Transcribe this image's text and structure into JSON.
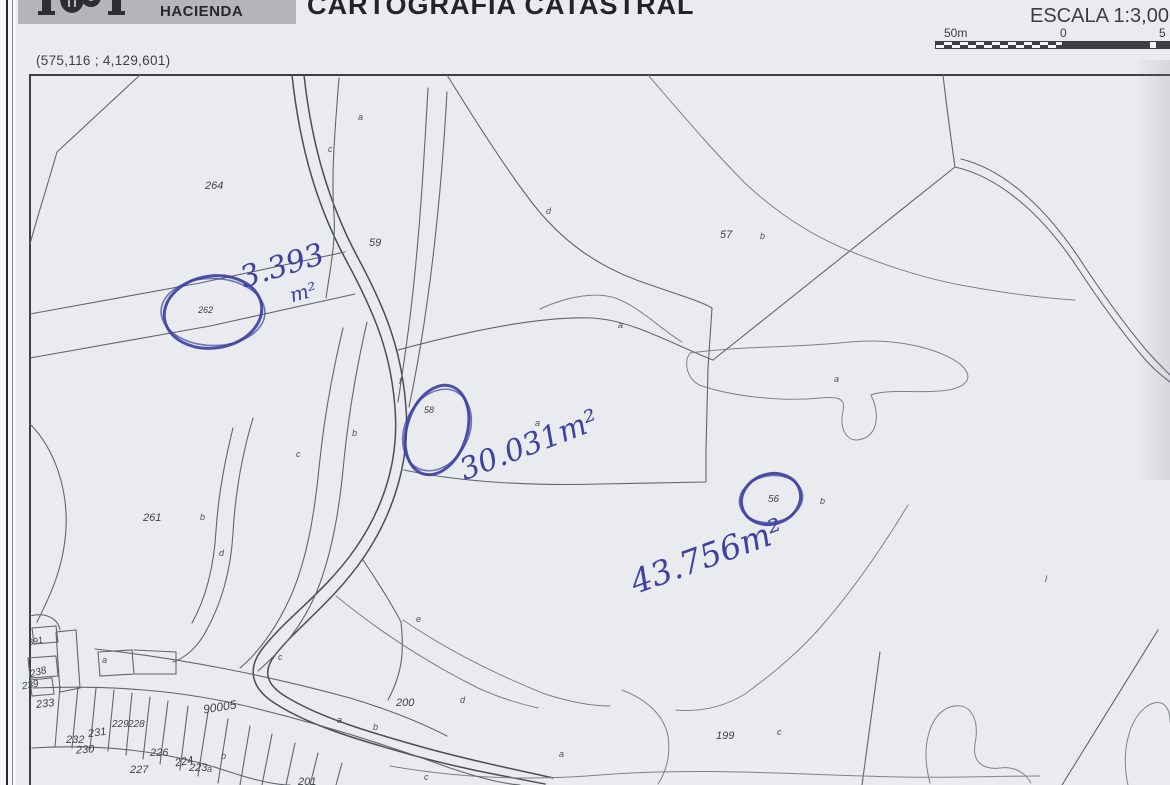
{
  "header": {
    "banner_text": "HACIENDA",
    "title": "CARTOGRAFIA CATASTRAL",
    "scale_label": "ESCALA 1:3,00",
    "scale_bar": {
      "left": "50m",
      "center": "0",
      "right": "5"
    }
  },
  "coordinates": "(575,116 ; 4,129,601)",
  "map": {
    "ink_color": "#3d41a0",
    "line_color": "#61656e",
    "parcel_labels": [
      {
        "t": "264",
        "x": 205,
        "y": 180
      },
      {
        "t": "59",
        "x": 369,
        "y": 237
      },
      {
        "t": "262",
        "x": 198,
        "y": 305,
        "s": 9
      },
      {
        "t": "57",
        "x": 720,
        "y": 229
      },
      {
        "t": "58",
        "x": 424,
        "y": 405,
        "s": 9
      },
      {
        "t": "56",
        "x": 768,
        "y": 494,
        "s": 10
      },
      {
        "t": "261",
        "x": 143,
        "y": 512
      },
      {
        "t": "200",
        "x": 396,
        "y": 697
      },
      {
        "t": "199",
        "x": 716,
        "y": 730
      },
      {
        "t": "90005",
        "x": 203,
        "y": 700,
        "s": 12,
        "rot": -9
      },
      {
        "t": "233",
        "x": 36,
        "y": 698,
        "rot": -6
      },
      {
        "t": "232",
        "x": 66,
        "y": 734
      },
      {
        "t": "231",
        "x": 88,
        "y": 727,
        "rot": -8
      },
      {
        "t": "230",
        "x": 76,
        "y": 744,
        "rot": -4
      },
      {
        "t": "229",
        "x": 112,
        "y": 719,
        "s": 10
      },
      {
        "t": "228",
        "x": 128,
        "y": 719,
        "s": 10
      },
      {
        "t": "226",
        "x": 150,
        "y": 747
      },
      {
        "t": "227",
        "x": 130,
        "y": 764
      },
      {
        "t": "224",
        "x": 175,
        "y": 756,
        "rot": -10
      },
      {
        "t": "223",
        "x": 189,
        "y": 762
      },
      {
        "t": "391",
        "x": 28,
        "y": 636,
        "s": 9,
        "rot": -12
      },
      {
        "t": "238",
        "x": 30,
        "y": 667,
        "s": 10,
        "rot": -15
      },
      {
        "t": "239",
        "x": 22,
        "y": 680,
        "s": 10,
        "rot": -10
      },
      {
        "t": "201",
        "x": 298,
        "y": 776
      }
    ],
    "letter_labels": [
      {
        "t": "a",
        "x": 358,
        "y": 112
      },
      {
        "t": "c",
        "x": 328,
        "y": 144
      },
      {
        "t": "d",
        "x": 546,
        "y": 206
      },
      {
        "t": "b",
        "x": 760,
        "y": 231
      },
      {
        "t": "a",
        "x": 618,
        "y": 320
      },
      {
        "t": "a",
        "x": 834,
        "y": 374
      },
      {
        "t": "a",
        "x": 535,
        "y": 418
      },
      {
        "t": "f",
        "x": 399,
        "y": 376
      },
      {
        "t": "b",
        "x": 352,
        "y": 428
      },
      {
        "t": "c",
        "x": 296,
        "y": 449
      },
      {
        "t": "b",
        "x": 200,
        "y": 512
      },
      {
        "t": "d",
        "x": 219,
        "y": 548
      },
      {
        "t": "e",
        "x": 416,
        "y": 614
      },
      {
        "t": "c",
        "x": 278,
        "y": 652
      },
      {
        "t": "a",
        "x": 102,
        "y": 655
      },
      {
        "t": "d",
        "x": 460,
        "y": 695
      },
      {
        "t": "a",
        "x": 337,
        "y": 715
      },
      {
        "t": "b",
        "x": 373,
        "y": 722
      },
      {
        "t": "c",
        "x": 424,
        "y": 772
      },
      {
        "t": "a",
        "x": 559,
        "y": 749
      },
      {
        "t": "c",
        "x": 777,
        "y": 727
      },
      {
        "t": "b",
        "x": 221,
        "y": 751
      },
      {
        "t": "a",
        "x": 207,
        "y": 764
      },
      {
        "t": "b",
        "x": 820,
        "y": 496
      },
      {
        "t": "l",
        "x": 1045,
        "y": 574
      }
    ],
    "annotations": [
      {
        "circle": {
          "cx": 213,
          "cy": 312,
          "rx": 49,
          "ry": 36,
          "rot": -8
        },
        "texts": [
          {
            "t": "3.393",
            "x": 236,
            "y": 262,
            "s": 30,
            "rot": -17
          },
          {
            "t": "m²",
            "x": 287,
            "y": 284,
            "s": 20,
            "rot": -15
          }
        ]
      },
      {
        "circle": {
          "cx": 437,
          "cy": 430,
          "rx": 30,
          "ry": 46,
          "rot": 18
        },
        "texts": [
          {
            "t": "30.031m²",
            "x": 455,
            "y": 455,
            "s": 30,
            "rot": -21
          }
        ]
      },
      {
        "circle": {
          "cx": 771,
          "cy": 499,
          "rx": 30,
          "ry": 25,
          "rot": -18
        },
        "texts": [
          {
            "t": "43.756m²",
            "x": 625,
            "y": 565,
            "s": 33,
            "rot": -20
          }
        ]
      }
    ]
  }
}
